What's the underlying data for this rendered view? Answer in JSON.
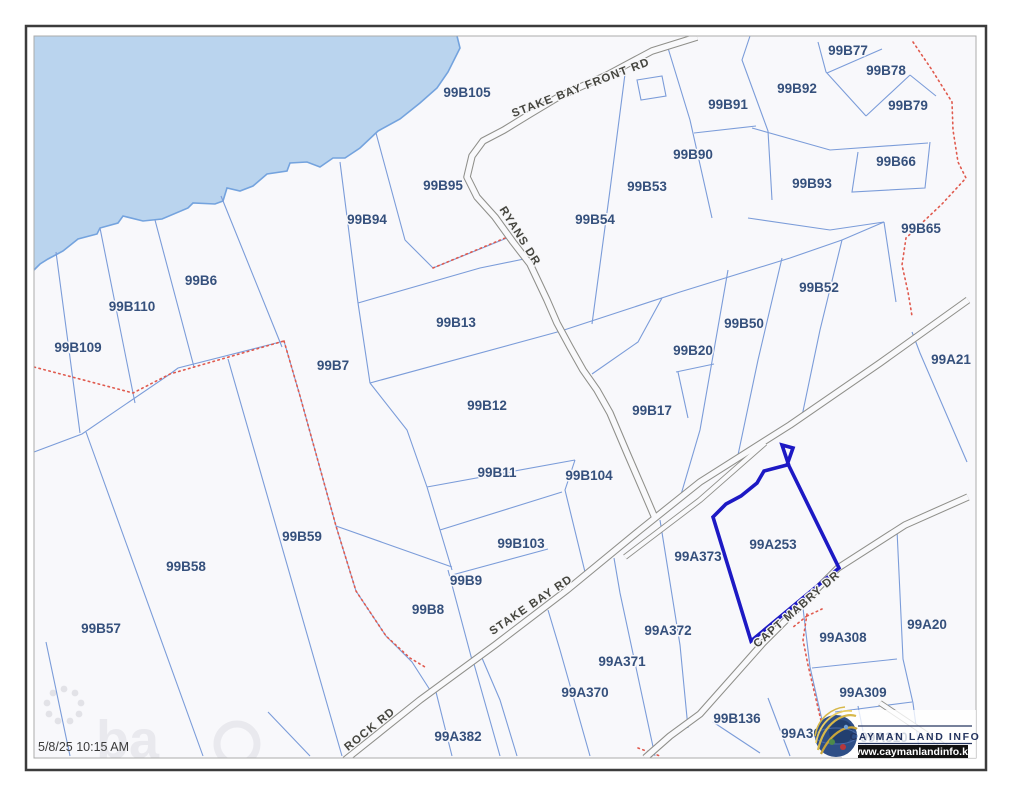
{
  "window": {
    "timestamp": "5/8/25 10:15 AM"
  },
  "map": {
    "highlighted_parcel": "99A253",
    "colors": {
      "water": "#bad4ee",
      "coast": "#74a3de",
      "parcel_line": "#7b9cd9",
      "road_casing": "#8f8f8a",
      "road_surface": "#f9f9fb",
      "highlight": "#1d19c4",
      "track_dotted": "#e05a4e",
      "label": "#35507c",
      "road_label": "#45453f",
      "land": "#f8f8fb"
    },
    "parcel_labels": [
      {
        "label": "99B105",
        "x": 467,
        "y": 97
      },
      {
        "label": "99B77",
        "x": 848,
        "y": 55
      },
      {
        "label": "99B78",
        "x": 886,
        "y": 75
      },
      {
        "label": "99B79",
        "x": 908,
        "y": 110
      },
      {
        "label": "99B92",
        "x": 797,
        "y": 93
      },
      {
        "label": "99B91",
        "x": 728,
        "y": 109
      },
      {
        "label": "99B90",
        "x": 693,
        "y": 159
      },
      {
        "label": "99B53",
        "x": 647,
        "y": 191
      },
      {
        "label": "99B95",
        "x": 443,
        "y": 190
      },
      {
        "label": "99B66",
        "x": 896,
        "y": 166
      },
      {
        "label": "99B93",
        "x": 812,
        "y": 188
      },
      {
        "label": "99B94",
        "x": 367,
        "y": 224
      },
      {
        "label": "99B54",
        "x": 595,
        "y": 224
      },
      {
        "label": "99B65",
        "x": 921,
        "y": 233
      },
      {
        "label": "99B6",
        "x": 201,
        "y": 285
      },
      {
        "label": "99B110",
        "x": 132,
        "y": 311
      },
      {
        "label": "99B52",
        "x": 819,
        "y": 292
      },
      {
        "label": "99B50",
        "x": 744,
        "y": 328
      },
      {
        "label": "99B109",
        "x": 78,
        "y": 352
      },
      {
        "label": "99B13",
        "x": 456,
        "y": 327
      },
      {
        "label": "99B20",
        "x": 693,
        "y": 355
      },
      {
        "label": "99B7",
        "x": 333,
        "y": 370
      },
      {
        "label": "99A21",
        "x": 951,
        "y": 364
      },
      {
        "label": "99B12",
        "x": 487,
        "y": 410
      },
      {
        "label": "99B17",
        "x": 652,
        "y": 415
      },
      {
        "label": "99B11",
        "x": 497,
        "y": 477
      },
      {
        "label": "99B104",
        "x": 589,
        "y": 480
      },
      {
        "label": "99A253",
        "x": 773,
        "y": 549
      },
      {
        "label": "99B59",
        "x": 302,
        "y": 541
      },
      {
        "label": "99B103",
        "x": 521,
        "y": 548
      },
      {
        "label": "99A373",
        "x": 698,
        "y": 561
      },
      {
        "label": "99B58",
        "x": 186,
        "y": 571
      },
      {
        "label": "99B9",
        "x": 466,
        "y": 585
      },
      {
        "label": "99B8",
        "x": 428,
        "y": 614
      },
      {
        "label": "99B57",
        "x": 101,
        "y": 633
      },
      {
        "label": "99A372",
        "x": 668,
        "y": 635
      },
      {
        "label": "99A308",
        "x": 843,
        "y": 642
      },
      {
        "label": "99A20",
        "x": 927,
        "y": 629
      },
      {
        "label": "99A371",
        "x": 622,
        "y": 666
      },
      {
        "label": "99A309",
        "x": 863,
        "y": 697
      },
      {
        "label": "99A370",
        "x": 585,
        "y": 697
      },
      {
        "label": "99B136",
        "x": 737,
        "y": 723
      },
      {
        "label": "99A382",
        "x": 458,
        "y": 741
      },
      {
        "label": "99A30",
        "x": 801,
        "y": 738
      },
      {
        "label": "99A310",
        "x": 884,
        "y": 742
      }
    ],
    "road_labels": [
      {
        "label": "STAKE BAY FRONT RD",
        "x": 582,
        "y": 91,
        "rotation": -21
      },
      {
        "label": "RYANS DR",
        "x": 517,
        "y": 238,
        "rotation": 58
      },
      {
        "label": "STAKE BAY RD",
        "x": 533,
        "y": 608,
        "rotation": -34
      },
      {
        "label": "ROCK RD",
        "x": 372,
        "y": 732,
        "rotation": -39
      },
      {
        "label": "CAPT MABRY DR",
        "x": 799,
        "y": 612,
        "rotation": -41
      }
    ],
    "watermark": {
      "text": "ba"
    }
  },
  "logo": {
    "title": "CAYMAN LAND INFO",
    "url_text": "www.caymanlandinfo.ky"
  }
}
